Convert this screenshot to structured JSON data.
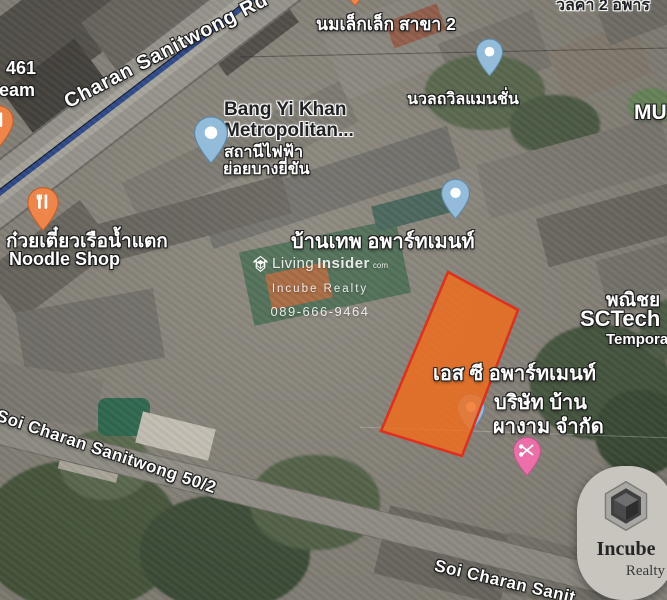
{
  "map": {
    "road_labels": {
      "main": "Charan Sanitwong Rd",
      "soi": "Soi Charan Sanitwong 50/2",
      "soi_bottom": "Soi Charan Sanit"
    },
    "poi_labels": {
      "milk_shop": "นมเล็กเล็ก สาขา 2",
      "mansion": "นวลถวิลแมนชั่น",
      "top_right_fragment": "วลคา 2 อพาร",
      "left_fragment_line1": "461",
      "left_fragment_line2": "ream",
      "mu_fragment": "MU",
      "bang_yi_khan_line1": "Bang Yi Khan",
      "bang_yi_khan_line2": "Metropolitan...",
      "bang_yi_khan_sub1": "สถานีไฟฟ้า",
      "bang_yi_khan_sub2": "ย่อยบางยี่ขัน",
      "noodle_thai": "ก๋วยเตี๋ยวเรือน้ำแตก",
      "noodle_en": "Noodle Shop",
      "baan_thep": "บ้านเทพ อพาร์ทเมนท์",
      "sc_apartment": "เอส ซี อพาร์ทเมนท์",
      "sc_company_line1": "บริษัท บ้าน",
      "sc_company_line2": "ผางาม จำกัด",
      "panich_fragment": "พณิชย",
      "sctech": "SCTech",
      "temporary_fragment": "Tempora"
    },
    "icons": {
      "restaurant_pin": "fork-knife",
      "poi_pin": "white-dot",
      "beauty_pin": "scissors",
      "brand_logo": "cube-in-hexagon",
      "watermark_logo": "cube-outline"
    },
    "colors": {
      "parcel_fill": "#F26C1B",
      "parcel_stroke": "#E02F1D",
      "route_line": "#2C4A8F",
      "pin_blue": "#92BCD9",
      "pin_orange": "#F0854A",
      "pin_pink": "#EC6FA9"
    }
  },
  "watermark": {
    "brand_prefix": "Living",
    "brand_suffix": "Insider",
    "brand_tld": "com",
    "company": "Incube Realty",
    "phone": "089-666-9464"
  },
  "logo": {
    "name": "Incube",
    "subname": "Realty"
  }
}
